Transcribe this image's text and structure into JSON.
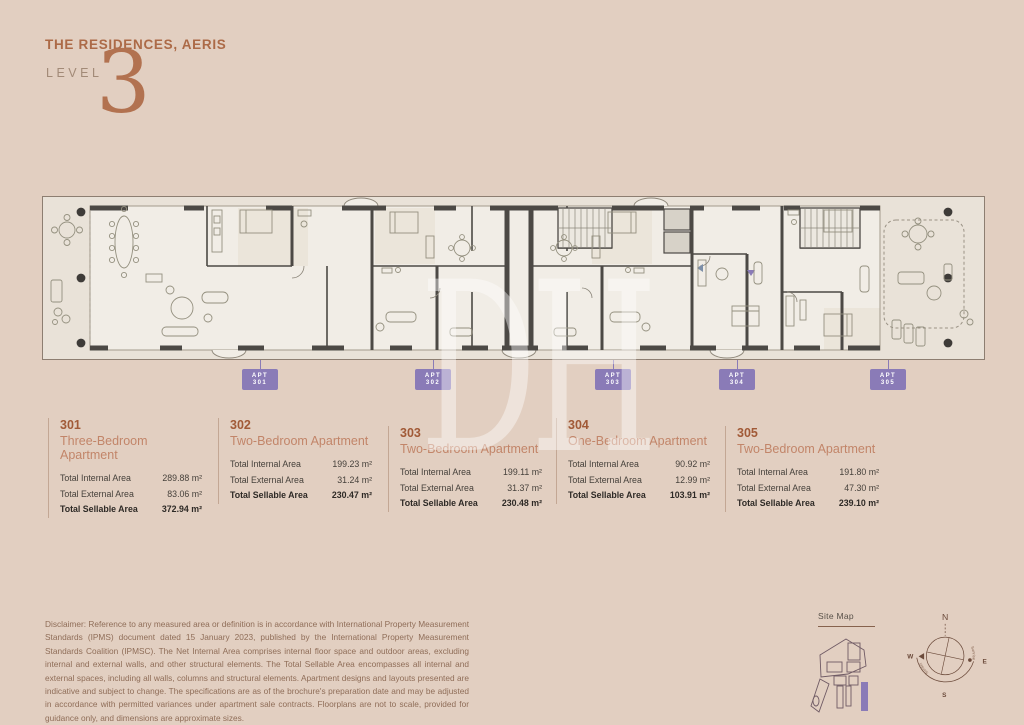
{
  "header": {
    "title": "THE RESIDENCES, AERIS",
    "level_label": "LEVEL",
    "level_number": "3",
    "watermark": "DH"
  },
  "floorplan": {
    "tags": [
      {
        "line1": "APT",
        "line2": "301"
      },
      {
        "line1": "APT",
        "line2": "302"
      },
      {
        "line1": "APT",
        "line2": "303"
      },
      {
        "line1": "APT",
        "line2": "304"
      },
      {
        "line1": "APT",
        "line2": "305"
      }
    ]
  },
  "apartments": [
    {
      "number": "301",
      "type": "Three-Bedroom Apartment",
      "rows": [
        {
          "label": "Total Internal Area",
          "value": "289.88 m²"
        },
        {
          "label": "Total External Area",
          "value": "83.06 m²"
        },
        {
          "label": "Total Sellable Area",
          "value": "372.94 m²"
        }
      ]
    },
    {
      "number": "302",
      "type": "Two-Bedroom Apartment",
      "rows": [
        {
          "label": "Total Internal Area",
          "value": "199.23 m²"
        },
        {
          "label": "Total External Area",
          "value": "31.24 m²"
        },
        {
          "label": "Total Sellable Area",
          "value": "230.47 m²"
        }
      ]
    },
    {
      "number": "303",
      "type": "Two-Bedroom Apartment",
      "rows": [
        {
          "label": "Total Internal Area",
          "value": "199.11 m²"
        },
        {
          "label": "Total External Area",
          "value": "31.37 m²"
        },
        {
          "label": "Total Sellable Area",
          "value": "230.48 m²"
        }
      ]
    },
    {
      "number": "304",
      "type": "One-Bedroom Apartment",
      "rows": [
        {
          "label": "Total Internal Area",
          "value": "90.92 m²"
        },
        {
          "label": "Total External Area",
          "value": "12.99 m²"
        },
        {
          "label": "Total Sellable Area",
          "value": "103.91 m²"
        }
      ]
    },
    {
      "number": "305",
      "type": "Two-Bedroom Apartment",
      "rows": [
        {
          "label": "Total Internal Area",
          "value": "191.80 m²"
        },
        {
          "label": "Total External Area",
          "value": "47.30 m²"
        },
        {
          "label": "Total Sellable Area",
          "value": "239.10 m²"
        }
      ]
    }
  ],
  "disclaimer": "Disclaimer: Reference to any measured area or definition is in accordance with International Property Measurement Standards (IPMS) document dated 15 January 2023, published by the International Property Measurement Standards Coalition (IPMSC). The Net Internal Area comprises internal floor space and outdoor areas, excluding internal and external walls, and other structural elements. The Total Sellable Area encompasses all internal and external spaces, including all walls, columns and structural elements. Apartment designs and layouts presented are indicative and subject to change. The specifications are as of the brochure's preparation date and may be adjusted in accordance with permitted variances under apartment sale contracts. Floorplans are not to scale, provided for guidance only, and dimensions are approximate sizes.",
  "site_map": {
    "label": "Site Map"
  },
  "compass": {
    "north": "N",
    "south": "S",
    "east": "E",
    "west": "W",
    "sunset_label": "Sunset",
    "sunrise_label": "Sunrise"
  },
  "colors": {
    "background": "#e2cfc1",
    "accent_terracotta": "#ac6a47",
    "apartment_number": "#a15a37",
    "apartment_type": "#c28569",
    "tag_purple": "#8a7bb7",
    "plan_wall": "#4c4945",
    "plan_interior": "#f1ede6",
    "plan_terrace": "#e9e2d8"
  }
}
